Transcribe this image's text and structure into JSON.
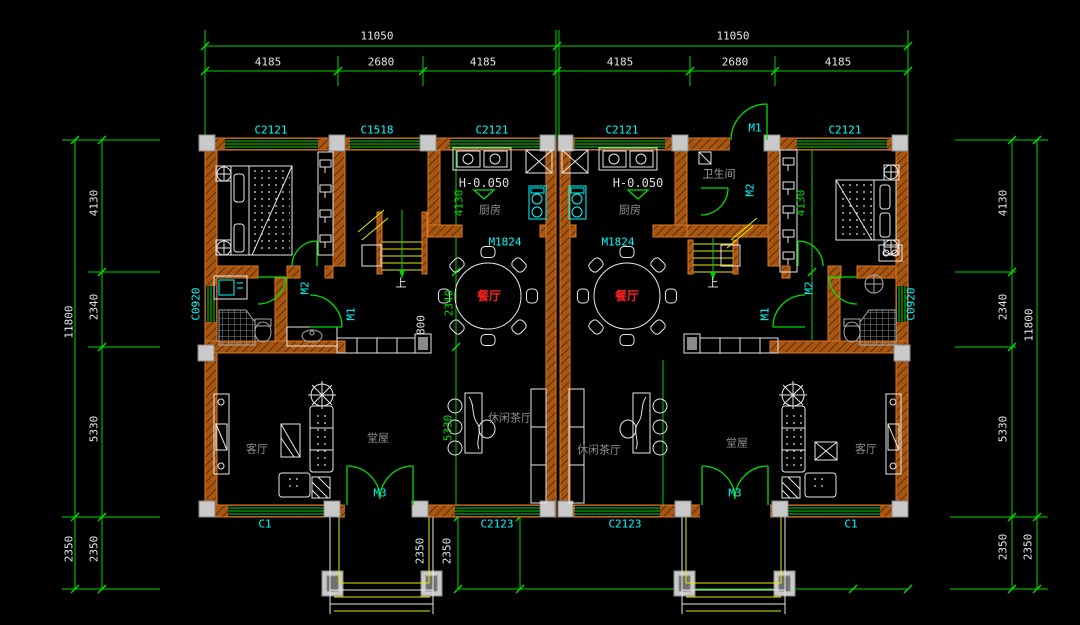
{
  "palette": {
    "dim_line": "#00d400",
    "dim_text": "#e6e6e6",
    "interior_dim_text": "#00e000",
    "opening_label": "#00ffff",
    "room_label": "#8f8f8f",
    "dining_label": "#ff1f1f",
    "wall": "#b35a12",
    "stair": "#e8e800",
    "furniture": "#e8e8e8",
    "column": "#c9c9c9"
  },
  "dimension_labels": [
    {
      "n": "dim-top-left-total",
      "t": "11050",
      "x": 377,
      "y": 36,
      "c": "#e6e6e6",
      "r": 0
    },
    {
      "n": "dim-top-left-seg1",
      "t": "4185",
      "x": 268,
      "y": 62,
      "c": "#e6e6e6",
      "r": 0
    },
    {
      "n": "dim-top-left-seg2",
      "t": "2680",
      "x": 381,
      "y": 62,
      "c": "#e6e6e6",
      "r": 0
    },
    {
      "n": "dim-top-left-seg3",
      "t": "4185",
      "x": 483,
      "y": 62,
      "c": "#e6e6e6",
      "r": 0
    },
    {
      "n": "dim-top-right-total",
      "t": "11050",
      "x": 733,
      "y": 36,
      "c": "#e6e6e6",
      "r": 0
    },
    {
      "n": "dim-top-right-seg1",
      "t": "4185",
      "x": 620,
      "y": 62,
      "c": "#e6e6e6",
      "r": 0
    },
    {
      "n": "dim-top-right-seg2",
      "t": "2680",
      "x": 735,
      "y": 62,
      "c": "#e6e6e6",
      "r": 0
    },
    {
      "n": "dim-top-right-seg3",
      "t": "4185",
      "x": 838,
      "y": 62,
      "c": "#e6e6e6",
      "r": 0
    },
    {
      "n": "dim-left-total",
      "t": "11800",
      "x": 69,
      "y": 322,
      "c": "#e6e6e6",
      "r": -90
    },
    {
      "n": "dim-left-seg1",
      "t": "4130",
      "x": 94,
      "y": 203,
      "c": "#e6e6e6",
      "r": -90
    },
    {
      "n": "dim-left-seg2",
      "t": "2340",
      "x": 94,
      "y": 307,
      "c": "#e6e6e6",
      "r": -90
    },
    {
      "n": "dim-left-seg3",
      "t": "5330",
      "x": 94,
      "y": 429,
      "c": "#e6e6e6",
      "r": -90
    },
    {
      "n": "dim-left-seg4",
      "t": "2350",
      "x": 94,
      "y": 549,
      "c": "#e6e6e6",
      "r": -90
    },
    {
      "n": "dim-left-outer-porch",
      "t": "2350",
      "x": 69,
      "y": 549,
      "c": "#e6e6e6",
      "r": -90
    },
    {
      "n": "dim-right-seg1",
      "t": "4130",
      "x": 1003,
      "y": 203,
      "c": "#e6e6e6",
      "r": -90
    },
    {
      "n": "dim-right-seg2",
      "t": "2340",
      "x": 1003,
      "y": 307,
      "c": "#e6e6e6",
      "r": -90
    },
    {
      "n": "dim-right-total",
      "t": "11800",
      "x": 1029,
      "y": 325,
      "c": "#e6e6e6",
      "r": -90
    },
    {
      "n": "dim-right-seg3",
      "t": "5330",
      "x": 1003,
      "y": 429,
      "c": "#e6e6e6",
      "r": -90
    },
    {
      "n": "dim-right-seg4",
      "t": "2350",
      "x": 1003,
      "y": 547,
      "c": "#e6e6e6",
      "r": -90
    },
    {
      "n": "dim-right-outer-porch",
      "t": "2350",
      "x": 1028,
      "y": 547,
      "c": "#e6e6e6",
      "r": -90
    },
    {
      "n": "dim-interior-left-4130",
      "t": "4130",
      "x": 459,
      "y": 203,
      "c": "#00e000",
      "r": -90
    },
    {
      "n": "dim-interior-left-2340",
      "t": "2340",
      "x": 449,
      "y": 303,
      "c": "#00e000",
      "r": -90
    },
    {
      "n": "dim-interior-left-5330",
      "t": "5330",
      "x": 448,
      "y": 428,
      "c": "#00e000",
      "r": -90
    },
    {
      "n": "dim-interior-left-800",
      "t": "800",
      "x": 421,
      "y": 325,
      "c": "#e6e6e6",
      "r": -90
    },
    {
      "n": "dim-interior-right-4130",
      "t": "4130",
      "x": 801,
      "y": 203,
      "c": "#00e000",
      "r": -90
    },
    {
      "n": "dim-porch-left-2350",
      "t": "2350",
      "x": 420,
      "y": 551,
      "c": "#e6e6e6",
      "r": -90
    },
    {
      "n": "dim-porch-right-2350",
      "t": "2350",
      "x": 447,
      "y": 551,
      "c": "#e6e6e6",
      "r": -90
    }
  ],
  "opening_labels": [
    {
      "n": "window-label-c2121-bedroom-left",
      "t": "C2121",
      "x": 271,
      "y": 130,
      "c": "#00ffff",
      "r": 0
    },
    {
      "n": "window-label-c1518",
      "t": "C1518",
      "x": 377,
      "y": 130,
      "c": "#00ffff",
      "r": 0
    },
    {
      "n": "window-label-c2121-kitchen-left",
      "t": "C2121",
      "x": 492,
      "y": 130,
      "c": "#00ffff",
      "r": 0
    },
    {
      "n": "window-label-c2121-kitchen-right",
      "t": "C2121",
      "x": 622,
      "y": 130,
      "c": "#00ffff",
      "r": 0
    },
    {
      "n": "door-label-m1-top",
      "t": "M1",
      "x": 755,
      "y": 128,
      "c": "#00ffff",
      "r": 0
    },
    {
      "n": "window-label-c2121-bedroom-right",
      "t": "C2121",
      "x": 845,
      "y": 130,
      "c": "#00ffff",
      "r": 0
    },
    {
      "n": "window-label-c0920-left",
      "t": "C0920",
      "x": 196,
      "y": 304,
      "c": "#00ffff",
      "r": -90
    },
    {
      "n": "window-label-c0920-right",
      "t": "C0920",
      "x": 911,
      "y": 304,
      "c": "#00ffff",
      "r": -90
    },
    {
      "n": "door-label-m1824-left",
      "t": "M1824",
      "x": 505,
      "y": 242,
      "c": "#00ffff",
      "r": 0
    },
    {
      "n": "door-label-m1824-right",
      "t": "M1824",
      "x": 618,
      "y": 242,
      "c": "#00ffff",
      "r": 0
    },
    {
      "n": "door-label-m2-bath-right-top",
      "t": "M2",
      "x": 750,
      "y": 190,
      "c": "#00ffff",
      "r": -90
    },
    {
      "n": "door-label-m2-mid-left",
      "t": "M2",
      "x": 305,
      "y": 288,
      "c": "#00ffff",
      "r": -90
    },
    {
      "n": "door-label-m1-mid-left",
      "t": "M1",
      "x": 351,
      "y": 314,
      "c": "#00ffff",
      "r": -90
    },
    {
      "n": "door-label-m2-mid-right",
      "t": "M2",
      "x": 809,
      "y": 288,
      "c": "#00ffff",
      "r": -90
    },
    {
      "n": "door-label-m1-mid-right",
      "t": "M1",
      "x": 765,
      "y": 314,
      "c": "#00ffff",
      "r": -90
    },
    {
      "n": "door-label-m3-left",
      "t": "M3",
      "x": 380,
      "y": 493,
      "c": "#00ffff",
      "r": 0
    },
    {
      "n": "door-label-m3-right",
      "t": "M3",
      "x": 735,
      "y": 493,
      "c": "#00ffff",
      "r": 0
    },
    {
      "n": "window-label-c1-left",
      "t": "C1",
      "x": 265,
      "y": 524,
      "c": "#00ffff",
      "r": 0
    },
    {
      "n": "window-label-c2123-left",
      "t": "C2123",
      "x": 497,
      "y": 524,
      "c": "#00ffff",
      "r": 0
    },
    {
      "n": "window-label-c2123-right",
      "t": "C2123",
      "x": 625,
      "y": 524,
      "c": "#00ffff",
      "r": 0
    },
    {
      "n": "window-label-c1-right",
      "t": "C1",
      "x": 851,
      "y": 524,
      "c": "#00ffff",
      "r": 0
    }
  ],
  "room_labels": [
    {
      "n": "room-kitchen-left",
      "t": "厨房",
      "x": 490,
      "y": 210,
      "c": "#8f8f8f",
      "r": 0
    },
    {
      "n": "room-kitchen-right",
      "t": "厨房",
      "x": 630,
      "y": 210,
      "c": "#8f8f8f",
      "r": 0
    },
    {
      "n": "room-bathroom-top-right",
      "t": "卫生间",
      "x": 719,
      "y": 174,
      "c": "#9f9f9f",
      "r": 0
    },
    {
      "n": "level-mark-left",
      "t": "H-0.050",
      "x": 484,
      "y": 183,
      "c": "#dedede",
      "r": 0,
      "s": 12
    },
    {
      "n": "level-mark-right",
      "t": "H-0.050",
      "x": 638,
      "y": 183,
      "c": "#dedede",
      "r": 0,
      "s": 12
    },
    {
      "n": "room-dining-left",
      "t": "餐厅",
      "x": 489,
      "y": 296,
      "c": "#ff1f1f",
      "r": 0,
      "s": 12,
      "b": 1
    },
    {
      "n": "room-dining-right",
      "t": "餐厅",
      "x": 627,
      "y": 296,
      "c": "#ff1f1f",
      "r": 0,
      "s": 12,
      "b": 1
    },
    {
      "n": "room-living-left",
      "t": "客厅",
      "x": 257,
      "y": 449,
      "c": "#8f8f8f",
      "r": 0
    },
    {
      "n": "room-living-right",
      "t": "客厅",
      "x": 866,
      "y": 449,
      "c": "#8f8f8f",
      "r": 0
    },
    {
      "n": "room-hall-left",
      "t": "堂屋",
      "x": 378,
      "y": 438,
      "c": "#8f8f8f",
      "r": 0
    },
    {
      "n": "room-hall-right",
      "t": "堂屋",
      "x": 737,
      "y": 443,
      "c": "#8f8f8f",
      "r": 0
    },
    {
      "n": "room-tea-left",
      "t": "休闲茶厅",
      "x": 510,
      "y": 418,
      "c": "#8f8f8f",
      "r": 0
    },
    {
      "n": "room-tea-right",
      "t": "休闲茶厅",
      "x": 599,
      "y": 450,
      "c": "#8f8f8f",
      "r": 0
    },
    {
      "n": "stair-up-left",
      "t": "上",
      "x": 401,
      "y": 283,
      "c": "#e8e8e8",
      "r": 0
    },
    {
      "n": "stair-up-right",
      "t": "上",
      "x": 713,
      "y": 283,
      "c": "#e8e8e8",
      "r": 0
    }
  ]
}
